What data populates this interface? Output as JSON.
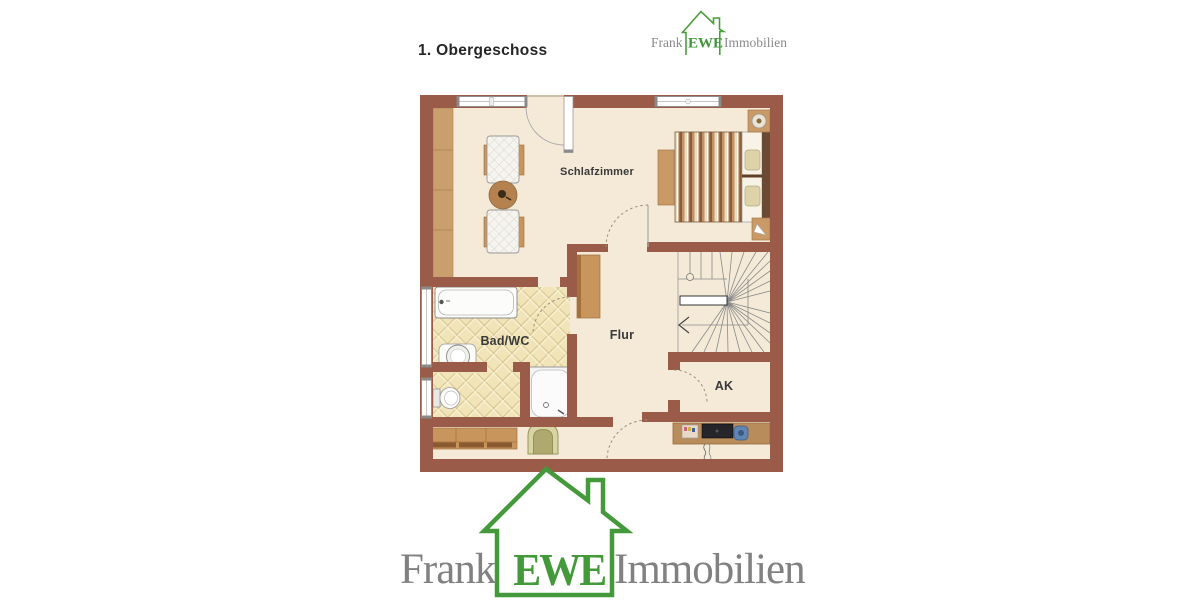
{
  "title": "1. Obergeschoss",
  "brand": {
    "first": "Frank",
    "middle": "EWE",
    "last": "Immobilien",
    "green": "#44993a",
    "gray": "#818181"
  },
  "plan": {
    "labels": {
      "bedroom": "Schlafzimmer",
      "bath": "Bad/WC",
      "hall": "Flur",
      "closet": "AK"
    },
    "colors": {
      "wall": "#9b5b49",
      "floor": "#f4ead7",
      "tile": "#f0e4b8",
      "wood": "#c8955c"
    }
  }
}
